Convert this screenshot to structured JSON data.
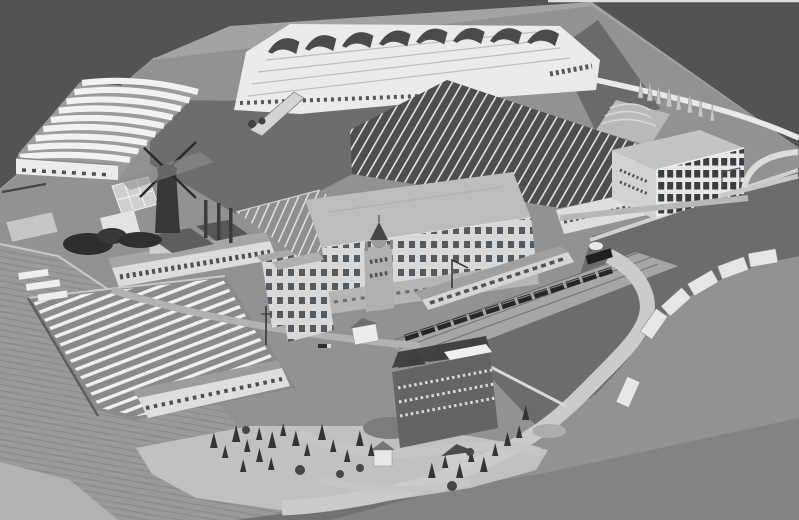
{
  "scene": {
    "alt": "Black-and-white aerial photograph of an architectural scale model of a large factory complex with curved-roof sheds, a terraced sawtooth factory, a long skylit production hall, a glazed office block, a windmill, chimneys, railway with trains, a villa with gardens, drying yards and a curving riverside road with barges",
    "title": "Scale model of industrial factory complex, bird's-eye photograph",
    "palette": {
      "backdrop": "#535353",
      "board": "#a3a3a3",
      "site": "#929292",
      "courtyard": "#6d6d6d",
      "water": "#6c6c6c",
      "slope": "#9a9a9a",
      "apron": "#c1c1c1",
      "road": "#cbcbcb",
      "road_bright": "#e9e9e9",
      "wall_white": "#ebebeb",
      "wall_light": "#d8d8d8",
      "roof_light": "#bdbdbd",
      "roof_mid": "#a0a0a0",
      "roof_dark": "#4e4e4e",
      "window_dark": "#4f5357",
      "stripe_white": "#f0f0f0",
      "tree_dark": "#343434",
      "tree_light": "#c6c6c6",
      "train": "#262626",
      "villa_wall": "#646464",
      "villa_roof": "#424242",
      "shadow": "#838383"
    },
    "elements": [
      {
        "name": "backdrop",
        "description": "dark grey studio backdrop behind the model"
      },
      {
        "name": "model-board",
        "description": "light grey base board of the model"
      },
      {
        "name": "curved-vault-shed",
        "description": "warehouse with nine white barrel-vault roof bays, upper left"
      },
      {
        "name": "terraced-factory",
        "description": "large white stepped factory with dark curved vault monitors along the ridge, top centre"
      },
      {
        "name": "skylit-hall",
        "description": "long dark roof hall with diagonal white skylight strips, centre right"
      },
      {
        "name": "glazed-office-block",
        "description": "four-storey block with dark glazing grid, right"
      },
      {
        "name": "main-office-building",
        "description": "flat roofed main building with window rows and central domed tower"
      },
      {
        "name": "windmill",
        "description": "dark smock windmill with four sails"
      },
      {
        "name": "boiler-chimneys",
        "description": "three slender factory chimneys"
      },
      {
        "name": "drying-yard",
        "description": "fenced yard filled with long white drying racks, lower left"
      },
      {
        "name": "arched-window-building",
        "description": "long low building with arched window row"
      },
      {
        "name": "railway",
        "description": "embankment with tracks, long dark passenger train and steam locomotive"
      },
      {
        "name": "harbour-water",
        "description": "dark water basin beside the railway"
      },
      {
        "name": "riverside-road",
        "description": "pale S-curved road sweeping around the lower right"
      },
      {
        "name": "barges",
        "description": "white covered barges moored in an arc along the quay"
      },
      {
        "name": "villa",
        "description": "dark brick mansion with steep gabled roofs and white roof canopy"
      },
      {
        "name": "gardens",
        "description": "garden with circular lawns, paths, conifers and round trees"
      },
      {
        "name": "poplar-row",
        "description": "row of pale poplars on the northern perimeter road"
      },
      {
        "name": "grass-slope",
        "description": "hatched grass embankment along the lower left edge"
      }
    ]
  }
}
